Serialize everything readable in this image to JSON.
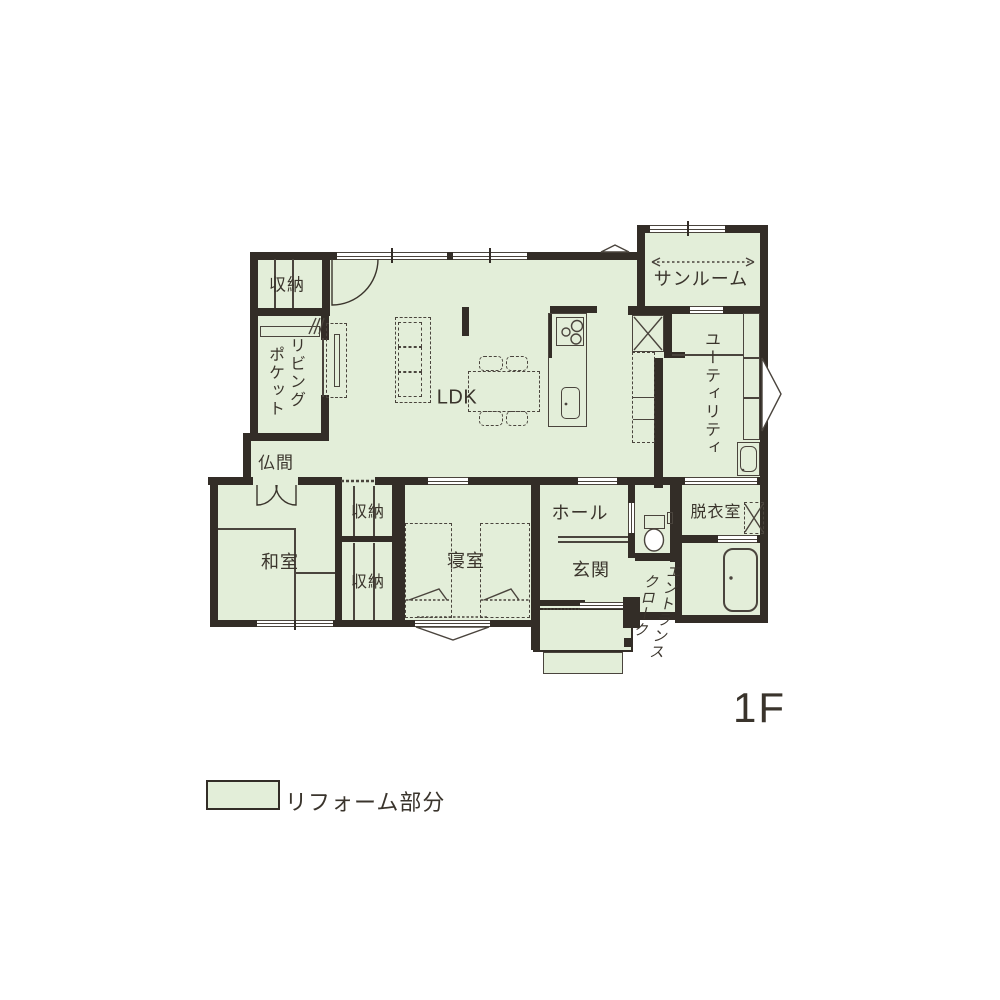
{
  "floor": {
    "label": "1F"
  },
  "legend": {
    "label": "リフォーム部分",
    "swatch_color": "#e3eed9"
  },
  "rooms": {
    "storage_nw": "収納",
    "living_pocket_right_col": "リビング",
    "living_pocket_left_col": "ポケット",
    "butsuma": "仏間",
    "ldk": "LDK",
    "sunroom": "サンルーム",
    "utility": "ユーティリティ",
    "washitsu": "和室",
    "storage_upper": "収納",
    "storage_lower": "収納",
    "bedroom": "寝室",
    "hall": "ホール",
    "genkan": "玄関",
    "entrance_cloak_right_col": "エントランス",
    "entrance_cloak_left_col": "クローク",
    "dressing_room": "脱衣室"
  },
  "colors": {
    "reform_green": "#e3eed9",
    "wall": "#332d27",
    "line": "#4a443d",
    "text": "#3a342c",
    "background": "#ffffff"
  }
}
